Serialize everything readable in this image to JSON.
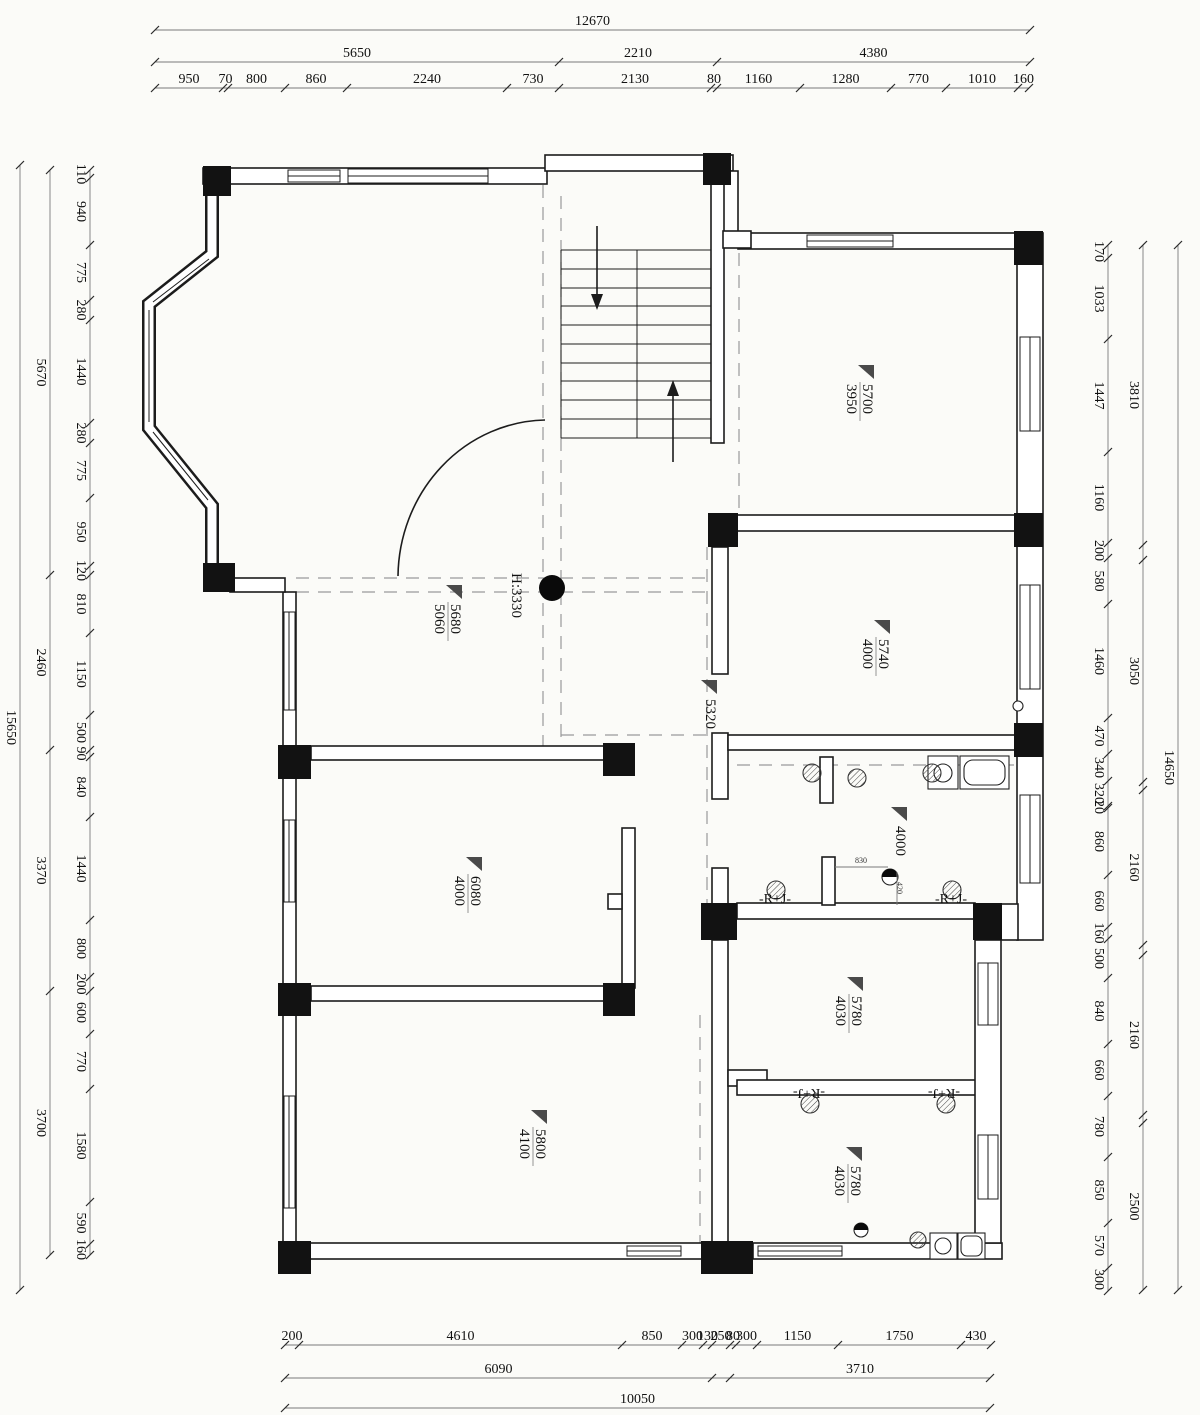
{
  "background": "#fbfbf8",
  "colors": {
    "line": "#1c1c1c",
    "dashed": "#9a9a9a",
    "column_fill": "#121212",
    "label_triangle": "#4a4a4a"
  },
  "dimensions": {
    "top": [
      {
        "dir": "h",
        "line": 30,
        "stops": [
          155,
          1030
        ],
        "labels": [
          "12670"
        ]
      },
      {
        "dir": "h",
        "line": 62,
        "stops": [
          155,
          559,
          717,
          1030
        ],
        "labels": [
          "5650",
          "2210",
          "4380"
        ]
      },
      {
        "dir": "h",
        "line": 88,
        "stops": [
          155,
          223,
          228,
          285,
          347,
          507,
          559,
          711,
          717,
          800,
          891,
          946,
          1018,
          1029
        ],
        "labels": [
          "950",
          "70",
          "800",
          "860",
          "2240",
          "730",
          "2130",
          "80",
          "1160",
          "1280",
          "770",
          "1010",
          "160"
        ]
      }
    ],
    "bottom": [
      {
        "dir": "h",
        "line": 1345,
        "stops": [
          285,
          299,
          622,
          682,
          703,
          712,
          730,
          736,
          757,
          838,
          961,
          991
        ],
        "labels": [
          "200",
          "4610",
          "850",
          "300",
          "130",
          "250",
          "80",
          "300",
          "1150",
          "1750",
          "430"
        ]
      },
      {
        "dir": "h",
        "line": 1378,
        "stops": [
          285,
          712,
          730,
          990
        ],
        "labels": [
          "6090",
          "",
          "3710"
        ]
      },
      {
        "dir": "h",
        "line": 1408,
        "stops": [
          285,
          990
        ],
        "labels": [
          "10050"
        ]
      }
    ],
    "left": [
      {
        "dir": "v",
        "line": 90,
        "stops": [
          170,
          178,
          245,
          300,
          320,
          423,
          443,
          498,
          566,
          575,
          633,
          715,
          750,
          757,
          817,
          920,
          977,
          991,
          1034,
          1089,
          1202,
          1244,
          1255
        ],
        "labels": [
          "110",
          "940",
          "775",
          "280",
          "1440",
          "280",
          "775",
          "950",
          "120",
          "810",
          "1150",
          "500",
          "90",
          "840",
          "1440",
          "800",
          "200",
          "600",
          "770",
          "1580",
          "590",
          "160"
        ]
      },
      {
        "dir": "v",
        "line": 50,
        "stops": [
          170,
          575,
          750,
          991,
          1255
        ],
        "labels": [
          "5670",
          "2460",
          "3370",
          "3700"
        ]
      },
      {
        "dir": "v",
        "line": 20,
        "stops": [
          165,
          1290
        ],
        "labels": [
          "15650"
        ]
      }
    ],
    "right": [
      {
        "dir": "v",
        "line": 1108,
        "stops": [
          245,
          258,
          339,
          452,
          543,
          558,
          604,
          718,
          754,
          781,
          806,
          808,
          875,
          927,
          939,
          978,
          1044,
          1096,
          1157,
          1223,
          1268,
          1291
        ],
        "labels": [
          "170",
          "1033",
          "1447",
          "1160",
          "200",
          "580",
          "1460",
          "470",
          "340",
          "320",
          "20",
          "860",
          "660",
          "160",
          "500",
          "840",
          "660",
          "780",
          "850",
          "570",
          "300"
        ]
      },
      {
        "dir": "v",
        "line": 1143,
        "stops": [
          245,
          545,
          560,
          782,
          790,
          945,
          955,
          1115,
          1123,
          1290
        ],
        "labels": [
          "3810",
          "",
          "3050",
          "",
          "2160",
          "",
          "2160",
          "",
          "2500"
        ]
      },
      {
        "dir": "v",
        "line": 1178,
        "stops": [
          245,
          1290
        ],
        "labels": [
          "14650"
        ]
      }
    ]
  },
  "rooms": [
    {
      "main": "5700",
      "sub": "3950",
      "x": 860,
      "y": 363
    },
    {
      "main": "5740",
      "sub": "4000",
      "x": 876,
      "y": 618
    },
    {
      "main": "5680",
      "sub": "5060",
      "x": 448,
      "y": 583
    },
    {
      "main": "6080",
      "sub": "4000",
      "x": 468,
      "y": 855
    },
    {
      "main": "5780",
      "sub": "4030",
      "x": 849,
      "y": 975
    },
    {
      "main": "5800",
      "sub": "4100",
      "x": 533,
      "y": 1108
    },
    {
      "main": "5780",
      "sub": "4030",
      "x": 848,
      "y": 1145
    },
    {
      "main": "4000",
      "sub": "",
      "x": 893,
      "y": 805
    },
    {
      "main": "5320",
      "sub": "",
      "x": 703,
      "y": 678
    }
  ],
  "annotations": {
    "ceiling_height": {
      "text": "H:3330",
      "x": 512,
      "y": 573
    },
    "rj_labels": [
      {
        "text": "-R+J-",
        "x": 775,
        "y": 903,
        "rot": 0
      },
      {
        "text": "-R+J-",
        "x": 951,
        "y": 903,
        "rot": 0
      },
      {
        "text": "-R+J-",
        "x": 809,
        "y": 1089,
        "rot": 180
      },
      {
        "text": "-R+J-",
        "x": 944,
        "y": 1089,
        "rot": 180
      }
    ],
    "small_dims": [
      {
        "text": "830",
        "x": 861,
        "y": 863,
        "rot": 0
      },
      {
        "text": "420",
        "x": 897,
        "y": 888,
        "rot": 90
      }
    ]
  }
}
